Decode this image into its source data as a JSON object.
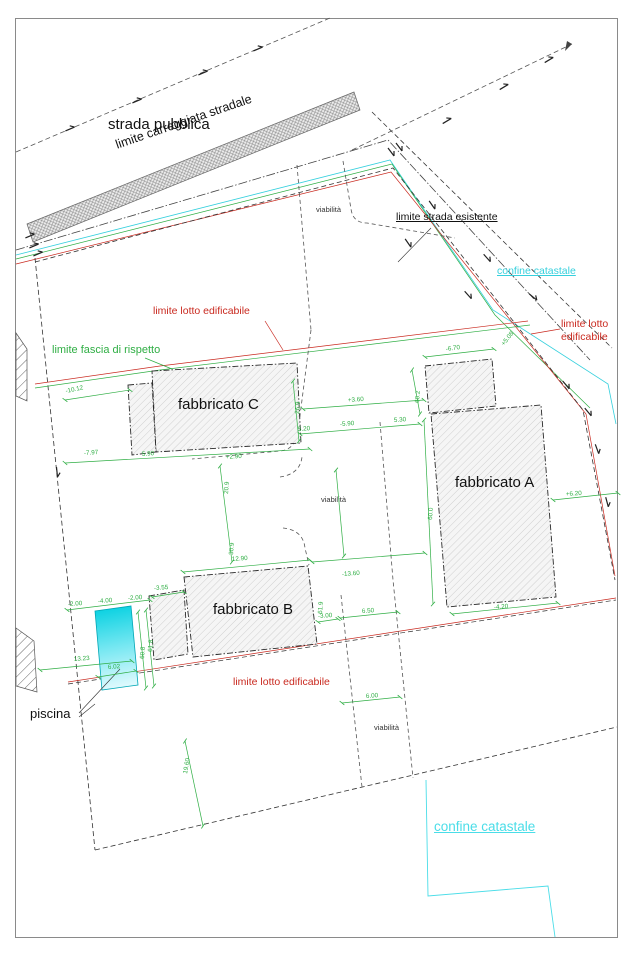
{
  "colors": {
    "cyan": "#35d0dd",
    "green": "#2fae44",
    "red": "#c9291f",
    "black": "#222222",
    "border": "#8a8a8a"
  },
  "labels": {
    "strada_pubblica": "strada pubblica",
    "carreggiata": "limite carreggiata stradale",
    "strada_esistente": "limite strada esistente",
    "confine_catastale": "confine catastale",
    "confine_catastale_bottom": "confine catastale",
    "lotto": "limite lotto edificabile",
    "lotto_bottom": "limite lotto edificabile",
    "lotto_r1": "limite lotto",
    "lotto_r2": "edificabile",
    "fascia": "limite fascia di rispetto",
    "viabilita": "viabilità",
    "fab_a": "fabbricato A",
    "fab_b": "fabbricato B",
    "fab_c": "fabbricato C",
    "piscina": "piscina"
  },
  "dim_labels": [
    {
      "t": "5.90",
      "x": 142,
      "y": 456,
      "r": -4
    },
    {
      "t": "+2.90",
      "x": 226,
      "y": 459,
      "r": -4
    },
    {
      "t": "26.9",
      "x": 299,
      "y": 414,
      "r": -86
    },
    {
      "t": "+3.60",
      "x": 348,
      "y": 402,
      "r": -4
    },
    {
      "t": "-5.90",
      "x": 340,
      "y": 426,
      "r": -4
    },
    {
      "t": "5.20",
      "x": 298,
      "y": 431,
      "r": -4
    },
    {
      "t": "5.30",
      "x": 394,
      "y": 422,
      "r": -4
    },
    {
      "t": "-13.60",
      "x": 342,
      "y": 576,
      "r": -4
    },
    {
      "t": "-6.70",
      "x": 446,
      "y": 351,
      "r": -8
    },
    {
      "t": "+5.08",
      "x": 504,
      "y": 346,
      "r": -52
    },
    {
      "t": "60.2",
      "x": 419,
      "y": 403,
      "r": -86
    },
    {
      "t": "60.0",
      "x": 432,
      "y": 520,
      "r": -86
    },
    {
      "t": "+6.20",
      "x": 566,
      "y": 496,
      "r": -4
    },
    {
      "t": "-4.20",
      "x": 494,
      "y": 609,
      "r": -4
    },
    {
      "t": "12.90",
      "x": 232,
      "y": 561,
      "r": -4
    },
    {
      "t": "-3.55",
      "x": 154,
      "y": 590,
      "r": -4
    },
    {
      "t": "-2.00",
      "x": 68,
      "y": 606,
      "r": -4
    },
    {
      "t": "-4.00",
      "x": 98,
      "y": 603,
      "r": -4
    },
    {
      "t": "-2.00",
      "x": 128,
      "y": 600,
      "r": -4
    },
    {
      "t": "61.9",
      "x": 322,
      "y": 614,
      "r": -86
    },
    {
      "t": "-3.00",
      "x": 318,
      "y": 618,
      "r": -4
    },
    {
      "t": "6.50",
      "x": 362,
      "y": 613,
      "r": -4
    },
    {
      "t": "6.00",
      "x": 366,
      "y": 698,
      "r": -4
    },
    {
      "t": "13.23",
      "x": 74,
      "y": 661,
      "r": -4
    },
    {
      "t": "6.02",
      "x": 108,
      "y": 669,
      "r": -4
    },
    {
      "t": "60.8",
      "x": 144,
      "y": 659,
      "r": -86
    },
    {
      "t": "61.8",
      "x": 152,
      "y": 652,
      "r": -86
    },
    {
      "t": "-10.12",
      "x": 66,
      "y": 393,
      "r": -12
    },
    {
      "t": "-7.97",
      "x": 84,
      "y": 455,
      "r": -4
    },
    {
      "t": "20.9",
      "x": 228,
      "y": 494,
      "r": -86
    },
    {
      "t": "30.9",
      "x": 233,
      "y": 555,
      "r": -86
    },
    {
      "t": "19.60",
      "x": 187,
      "y": 774,
      "r": -80
    }
  ],
  "dim_lines": [
    [
      65,
      463,
      310,
      449
    ],
    [
      300,
      434,
      420,
      424
    ],
    [
      303,
      409,
      424,
      400
    ],
    [
      293,
      381,
      299,
      441
    ],
    [
      220,
      466,
      232,
      562
    ],
    [
      65,
      400,
      130,
      390
    ],
    [
      425,
      357,
      494,
      349
    ],
    [
      412,
      370,
      420,
      414
    ],
    [
      424,
      420,
      433,
      604
    ],
    [
      553,
      500,
      618,
      493
    ],
    [
      452,
      614,
      558,
      603
    ],
    [
      183,
      572,
      310,
      560
    ],
    [
      312,
      562,
      425,
      553
    ],
    [
      67,
      610,
      150,
      600
    ],
    [
      40,
      670,
      132,
      661
    ],
    [
      98,
      677,
      136,
      671
    ],
    [
      138,
      612,
      146,
      688
    ],
    [
      146,
      610,
      154,
      686
    ],
    [
      340,
      618,
      398,
      612
    ],
    [
      342,
      703,
      400,
      697
    ],
    [
      185,
      741,
      203,
      826
    ],
    [
      152,
      597,
      184,
      592
    ],
    [
      318,
      622,
      338,
      619
    ],
    [
      336,
      470,
      344,
      556
    ]
  ],
  "tick_marks": [
    [
      70,
      129,
      -23
    ],
    [
      137,
      101,
      -23
    ],
    [
      203,
      73,
      -23
    ],
    [
      258,
      49,
      -23
    ],
    [
      447,
      121,
      -31
    ],
    [
      504,
      87,
      -31
    ],
    [
      549,
      60,
      -31
    ],
    [
      432,
      205,
      55
    ],
    [
      408,
      243,
      55
    ],
    [
      487,
      258,
      48
    ],
    [
      468,
      295,
      48
    ],
    [
      533,
      297,
      40
    ],
    [
      566,
      385,
      50
    ],
    [
      588,
      412,
      50
    ],
    [
      597,
      449,
      70
    ],
    [
      607,
      502,
      75
    ],
    [
      391,
      152,
      53
    ],
    [
      399,
      147,
      53
    ],
    [
      30,
      236,
      -23
    ],
    [
      34,
      246,
      -23
    ],
    [
      38,
      254,
      -23
    ],
    [
      57,
      472,
      84
    ]
  ]
}
